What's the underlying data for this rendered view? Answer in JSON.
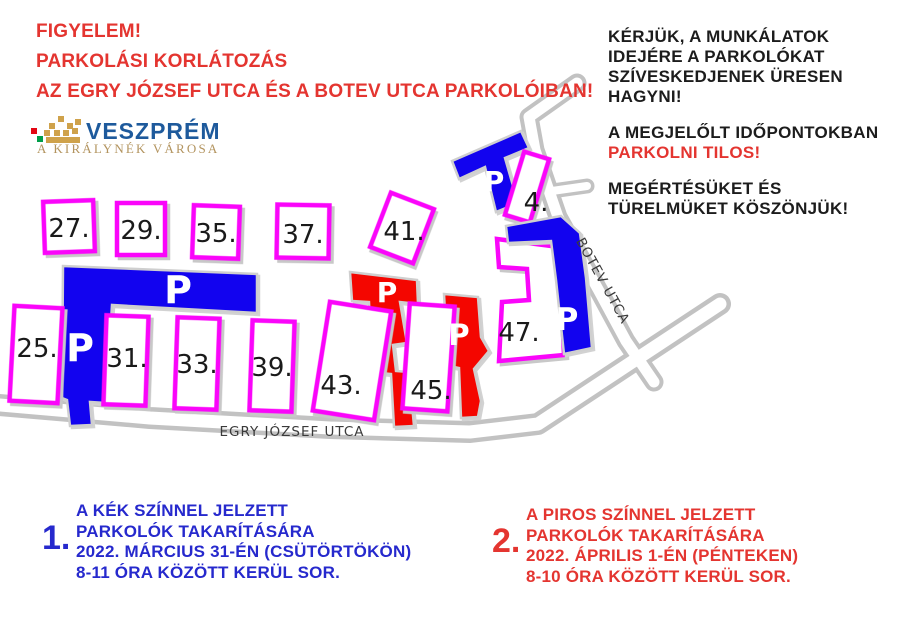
{
  "title": {
    "line1": "FIGYELEM!",
    "line2": "PARKOLÁSI KORLÁTOZÁS",
    "line3": "AZ EGRY JÓZSEF UTCA ÉS A BOTEV UTCA PARKOLÓIBAN!"
  },
  "logo": {
    "city": "VESZPRÉM",
    "tagline": "A KIRÁLYNÉK VÁROSA",
    "colors": {
      "city_blue": "#1e5a9c",
      "tagline_gold": "#b3945f",
      "crown_gold": "#cfa24b",
      "crown_red": "#e30613",
      "crown_green": "#009e49"
    }
  },
  "notice": {
    "request": [
      "KÉRJÜK, A MUNKÁLATOK",
      "IDEJÉRE A PARKOLÓKAT",
      "SZÍVESKEDJENEK ÜRESEN",
      "HAGYNI!"
    ],
    "prohibition": [
      "A MEGJELŐLT IDŐPONTOKBAN",
      "PARKOLNI TILOS!"
    ],
    "thanks": [
      "MEGÉRTÉSÜKET ÉS",
      "TÜRELMÜKET KÖSZÖNJÜK!"
    ]
  },
  "map": {
    "streets": {
      "egry": "EGRY JÓZSEF UTCA",
      "botev": "BOTEV UTCA"
    },
    "parking_letter": "P",
    "building_numbers": [
      "27.",
      "29.",
      "35.",
      "37.",
      "41.",
      "4.",
      "25.",
      "31.",
      "33.",
      "39.",
      "43.",
      "45.",
      "47."
    ],
    "colors": {
      "blue_parking": "#1203ef",
      "red_parking": "#f40600",
      "building_outline": "#fa05fa",
      "road_gray": "#c2c2c2",
      "label_dark": "#1a1a1a"
    }
  },
  "legend": {
    "one": {
      "num": "1.",
      "lines": [
        "A KÉK SZÍNNEL JELZETT",
        "PARKOLÓK TAKARÍTÁSÁRA",
        "2022. MÁRCIUS 31-ÉN (CSÜTÖRTÖKÖN)",
        "8-11 ÓRA KÖZÖTT KERÜL SOR."
      ]
    },
    "two": {
      "num": "2.",
      "lines": [
        "A PIROS SZÍNNEL JELZETT",
        "PARKOLÓK TAKARÍTÁSÁRA",
        "2022. ÁPRILIS 1-ÉN (PÉNTEKEN)",
        "8-10 ÓRA KÖZÖTT KERÜL SOR."
      ]
    }
  },
  "colors": {
    "title_red": "#e43530",
    "legend_blue": "#2629cd",
    "notice_black": "#1c1c1c"
  }
}
